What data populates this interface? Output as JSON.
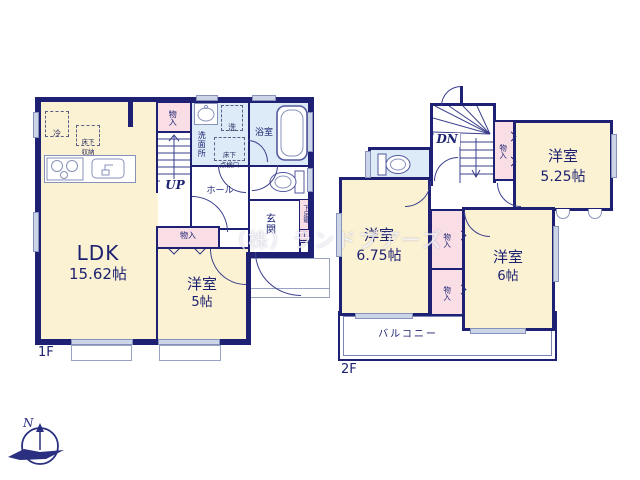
{
  "watermark": "（株）ランドプアーズ",
  "compass": {
    "north_label": "N"
  },
  "colors": {
    "wall": "#1e2173",
    "room_floor": "#fbf1d3",
    "closet_floor": "#f9dee6",
    "wet_floor": "#dcebf7"
  },
  "floor1": {
    "floor_label": "1F",
    "rooms": {
      "ldk": {
        "name": "LDK",
        "size": "15.62帖"
      },
      "bedroom5": {
        "name": "洋室",
        "size": "5帖"
      },
      "washroom": {
        "name": "洗面所"
      },
      "bathroom": {
        "name": "浴室"
      },
      "hall": {
        "name": "ホール"
      },
      "entrance": {
        "name": "玄関"
      }
    },
    "labels": {
      "fridge": "冷",
      "underfloor_storage": "床下\n収納",
      "washer": "洗",
      "underfloor_access": "床下\n点検口",
      "closet_top": "物入",
      "closet_mid": "物入",
      "shoe_box": "下足箱",
      "shoe_box_t": "T",
      "stairs_up": "UP"
    }
  },
  "floor2": {
    "floor_label": "2F",
    "rooms": {
      "bedroom525": {
        "name": "洋室",
        "size": "5.25帖"
      },
      "bedroom675": {
        "name": "洋室",
        "size": "6.75帖"
      },
      "bedroom6": {
        "name": "洋室",
        "size": "6帖"
      },
      "balcony": {
        "name": "バルコニー"
      }
    },
    "labels": {
      "stairs_down": "DN",
      "closet_a": "物入",
      "closet_b": "物入",
      "closet_c": "物入"
    }
  }
}
